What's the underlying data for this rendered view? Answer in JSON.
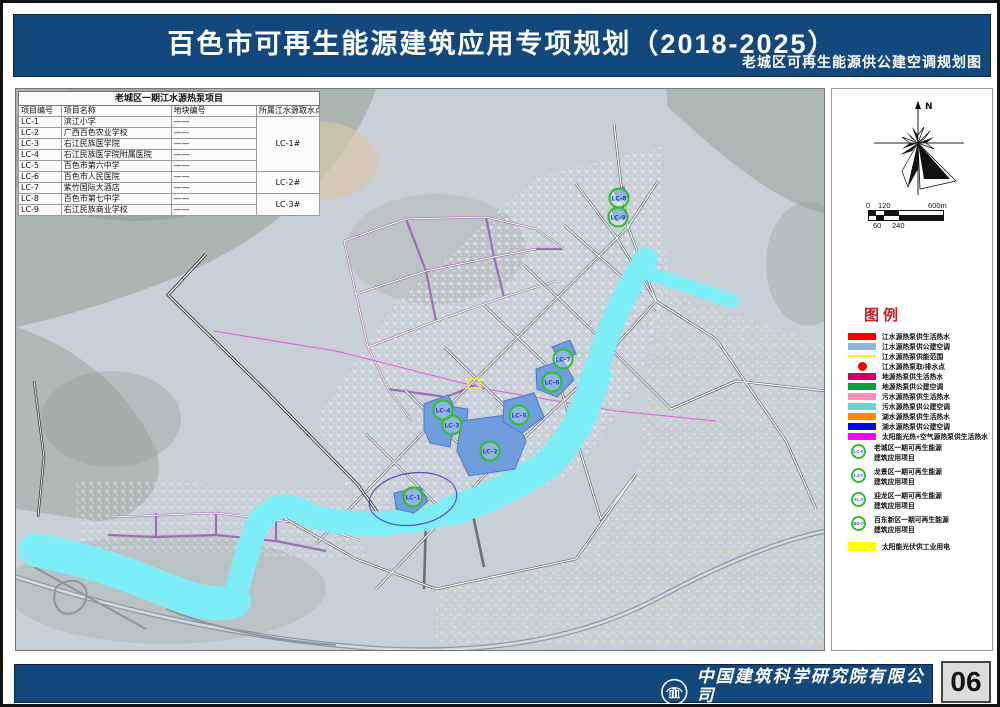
{
  "header": {
    "title": "百色市可再生能源建筑应用专项规划（2018-2025）",
    "subtitle": "老城区可再生能源供公建空调规划图"
  },
  "project_table": {
    "title": "老城区一期江水源热泵项目",
    "columns": [
      "项目编号",
      "项目名称",
      "地块编号",
      "所属江水源取水点"
    ],
    "rows": [
      {
        "id": "LC-1",
        "name": "滨江小学",
        "block": "——"
      },
      {
        "id": "LC-2",
        "name": "广西百色农业学校",
        "block": "——"
      },
      {
        "id": "LC-3",
        "name": "右江民族医学院",
        "block": "——"
      },
      {
        "id": "LC-4",
        "name": "右江民族医学院附属医院",
        "block": "——"
      },
      {
        "id": "LC-5",
        "name": "百色市第六中学",
        "block": "——"
      },
      {
        "id": "LC-6",
        "name": "百色市人民医院",
        "block": "——"
      },
      {
        "id": "LC-7",
        "name": "紫竹国际大酒店",
        "block": "——"
      },
      {
        "id": "LC-8",
        "name": "百色市第七中学",
        "block": "——"
      },
      {
        "id": "LC-9",
        "name": "右江民族商业学校",
        "block": "——"
      }
    ],
    "intake_groups": [
      {
        "label": "LC-1#",
        "span": 5
      },
      {
        "label": "LC-2#",
        "span": 2
      },
      {
        "label": "LC-3#",
        "span": 2
      }
    ]
  },
  "map": {
    "markers": [
      {
        "label": "LC-1"
      },
      {
        "label": "LC-2"
      },
      {
        "label": "LC-3"
      },
      {
        "label": "LC-4"
      },
      {
        "label": "LC-5"
      },
      {
        "label": "LC-6"
      },
      {
        "label": "LC-7"
      },
      {
        "label": "LC-8"
      },
      {
        "label": "LC-9"
      }
    ],
    "colors": {
      "river": "#7deef8",
      "site_fill": "#6f9ddd",
      "site_border": "#4c7ac6",
      "marker_ring": "#2fc12f"
    }
  },
  "compass": {
    "north_label": "N"
  },
  "scale_bar": {
    "top_labels": [
      "0",
      "120",
      "600m"
    ],
    "bottom_labels": [
      "60",
      "240"
    ]
  },
  "legend": {
    "title": "图例",
    "items": [
      {
        "label": "江水源热泵供生活热水",
        "color": "#ff0000",
        "shape": "rect"
      },
      {
        "label": "江水源热泵供公建空调",
        "color": "#8db4e2",
        "shape": "rect"
      },
      {
        "label": "江水源热泵供能范围",
        "color": "#f5f51e",
        "shape": "line"
      },
      {
        "label": "江水源热泵取/排水点",
        "color": "#ff0000",
        "shape": "dot"
      },
      {
        "label": "地源热泵供生活热水",
        "color": "#cc0066",
        "shape": "rect"
      },
      {
        "label": "地源热泵供公建空调",
        "color": "#00a33c",
        "shape": "rect"
      },
      {
        "label": "污水源热泵供生活热水",
        "color": "#ff8cb4",
        "shape": "rect"
      },
      {
        "label": "污水源热泵供公建空调",
        "color": "#63d6ce",
        "shape": "rect"
      },
      {
        "label": "湖水源热泵供生活热水",
        "color": "#ff8a00",
        "shape": "rect"
      },
      {
        "label": "湖水源热泵供公建空调",
        "color": "#0000ff",
        "shape": "rect"
      },
      {
        "label": "太阳能光热+空气源热泵供生活热水",
        "color": "#ff00ff",
        "shape": "rect"
      }
    ],
    "project_items": [
      {
        "badge": "LC-#",
        "line1": "老城区一期可再生能源",
        "line2": "建筑应用项目"
      },
      {
        "badge": "LJ-#",
        "line1": "龙景区一期可再生能源",
        "line2": "建筑应用项目"
      },
      {
        "badge": "YL-#",
        "line1": "迎龙区一期可再生能源",
        "line2": "建筑应用项目"
      },
      {
        "badge": "BD-#",
        "line1": "百东新区一期可再生能源",
        "line2": "建筑应用项目"
      }
    ],
    "solar_item": {
      "label": "太阳能光伏供工业用电",
      "color": "#ffff00"
    }
  },
  "footer": {
    "org_cn": "中国建筑科学研究院有限公司",
    "org_en": "China Academy of Building Research",
    "page_number": "06"
  }
}
